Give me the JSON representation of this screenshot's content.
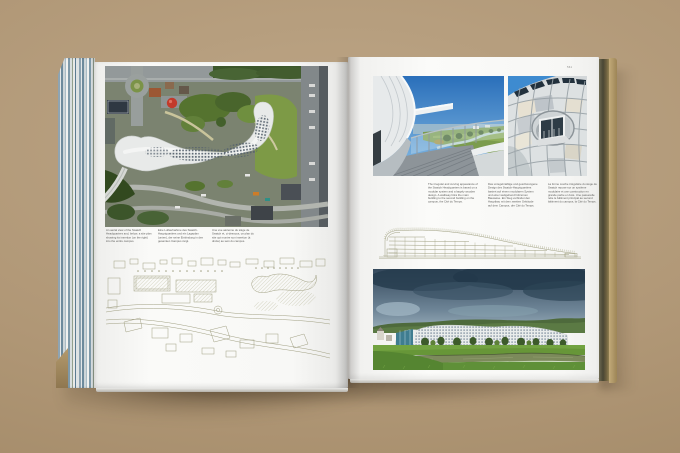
{
  "scene": {
    "description": "Open architecture book photographed on a tan surface, spread about the Swatch Headquarters",
    "surface_color": "#b09776",
    "page_color": "#fafaf8"
  },
  "book": {
    "left_page": {
      "aerial_photo": "aerial view of the curving Swatch Headquarters building and surrounding streets",
      "site_plan": "line-drawing site plan of the campus with river and serpentine building",
      "captions": [
        {
          "lang": "en",
          "text": "An aerial view of the Swatch Headquarters and, below, a site plan showing its insertion (on the right) into the entire campus."
        },
        {
          "lang": "de",
          "text": "Eine Luftaufnahme des Swatch-Hauptquartiers und ein Lageplan (unten), der seine Einbindung in den gesamten Campus zeigt."
        },
        {
          "lang": "fr",
          "text": "Une vue aérienne du siège de Swatch et, ci-dessous, un plan du site qui montre son insertion (à droite) au sein du campus."
        }
      ]
    },
    "right_page": {
      "page_number": "561",
      "terrace_photo": "roof terrace along the curved white gridshell with river landscape",
      "facade_detail_photo": "close-up of gridshell facade with projecting bay window",
      "section_drawing": "longitudinal section of the long curved building",
      "panorama_photo": "panorama of the white building along the river under a stormy sky",
      "captions": [
        {
          "lang": "en",
          "text": "The irregular and curving appearance of the Swatch Headquarters is based on a modular system and a largely wooden design. A walkway links the main building to the second building on the campus, the Cité du Temps."
        },
        {
          "lang": "de",
          "text": "Das unregelmäßige und geschwungene Design des Swatch-Hauptquartiers basiert auf einem modularen System und einer weitgehend hölzernen Bauweise. Ein Steg verbindet den Hauptbau mit dem zweiten Gebäude auf dem Campus, der Cité du Temps."
        },
        {
          "lang": "fr",
          "text": "La forme courbe irrégulière du siège de Swatch repose sur un système modulaire et une construction en grande partie en bois. Une passerelle relie le bâtiment principal au second bâtiment du campus, la Cité du Temps."
        }
      ]
    }
  }
}
